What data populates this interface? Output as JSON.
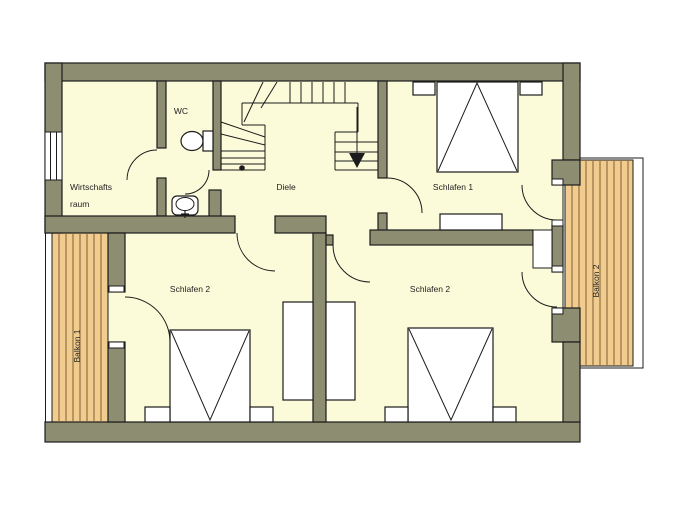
{
  "floorplan": {
    "background": "#ffffff",
    "colors": {
      "wall_fill": "#8d8d72",
      "outline": "#1c1c1c",
      "floor_fill": "#fbfbd9",
      "balcony_fill": "#f1cc8e",
      "balcony_plank_line": "#7d5f36",
      "furniture_fill": "#ffffff",
      "label_color": "#222222"
    },
    "labels": {
      "wirtschaftsraum_line1": "Wirtschafts",
      "wirtschaftsraum_line2": "raum",
      "wc": "WC",
      "diele": "Diele",
      "schlafen1": "Schlafen 1",
      "schlafen2_left": "Schlafen 2",
      "schlafen2_right": "Schlafen 2",
      "balkon1": "Balkon 1",
      "balkon2": "Balkon 2"
    },
    "icons": {
      "stair_direction_arrow": "down-arrow",
      "stair_start_dot": "dot"
    }
  }
}
